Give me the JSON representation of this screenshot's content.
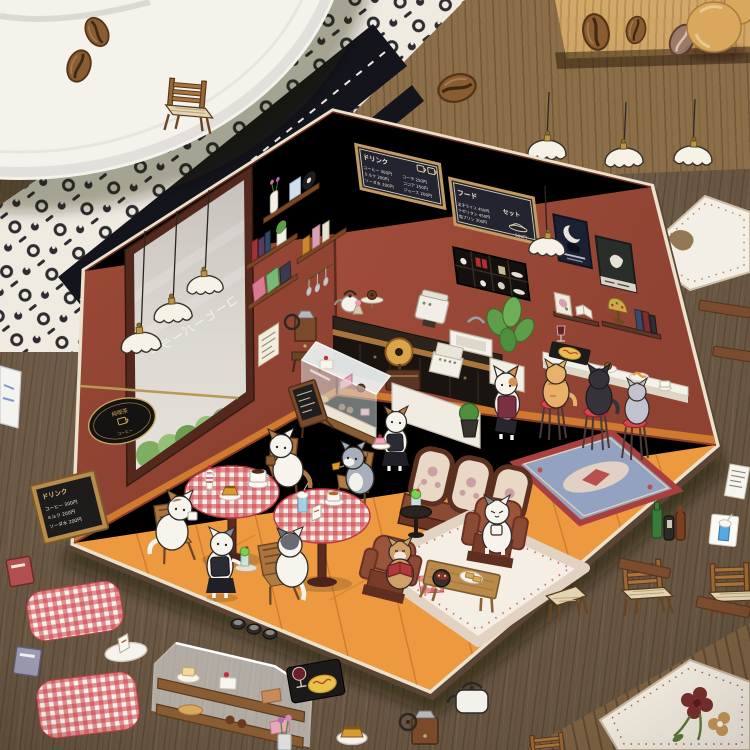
{
  "diorama": {
    "menu_board_drinks": {
      "title": "ドリンク",
      "col1": [
        "コーヒー 300円",
        "ミルク 200円",
        "ソーダ水 200円"
      ],
      "col2": [
        "コーラ 250円",
        "ココア 250円",
        "ジュース 200円"
      ]
    },
    "menu_board_food": {
      "title": "フード",
      "set_label": "セット",
      "items": [
        "玉子ライス 450円",
        "ナポリタン 450円",
        "塩プリン 300円"
      ],
      "set_price": "500円"
    },
    "window_text": "コーヒーパーラー",
    "oval_sign": {
      "line1": "純喫茶",
      "line2": "コーヒー"
    }
  },
  "stickers": {
    "chalkboard_menu": {
      "title": "ドリンク",
      "rows": [
        "コーヒー 300円",
        "ミルク 200円",
        "ソーダ水 200円"
      ]
    }
  },
  "colors": {
    "wall": "#9c4a38",
    "floor": "#ec9940",
    "wood_table": "#6f5b45",
    "wood_light": "#c59a5f",
    "fabric_black": "#16161e",
    "gingham_red": "#d04048",
    "stool_red": "#d8444c",
    "menu_board_bg": "#232430",
    "menu_board_frame": "#c29a62",
    "sofa_brown": "#8a4a34",
    "rug_blue": "#93a2c0",
    "cream_paper": "#ece2cc"
  }
}
